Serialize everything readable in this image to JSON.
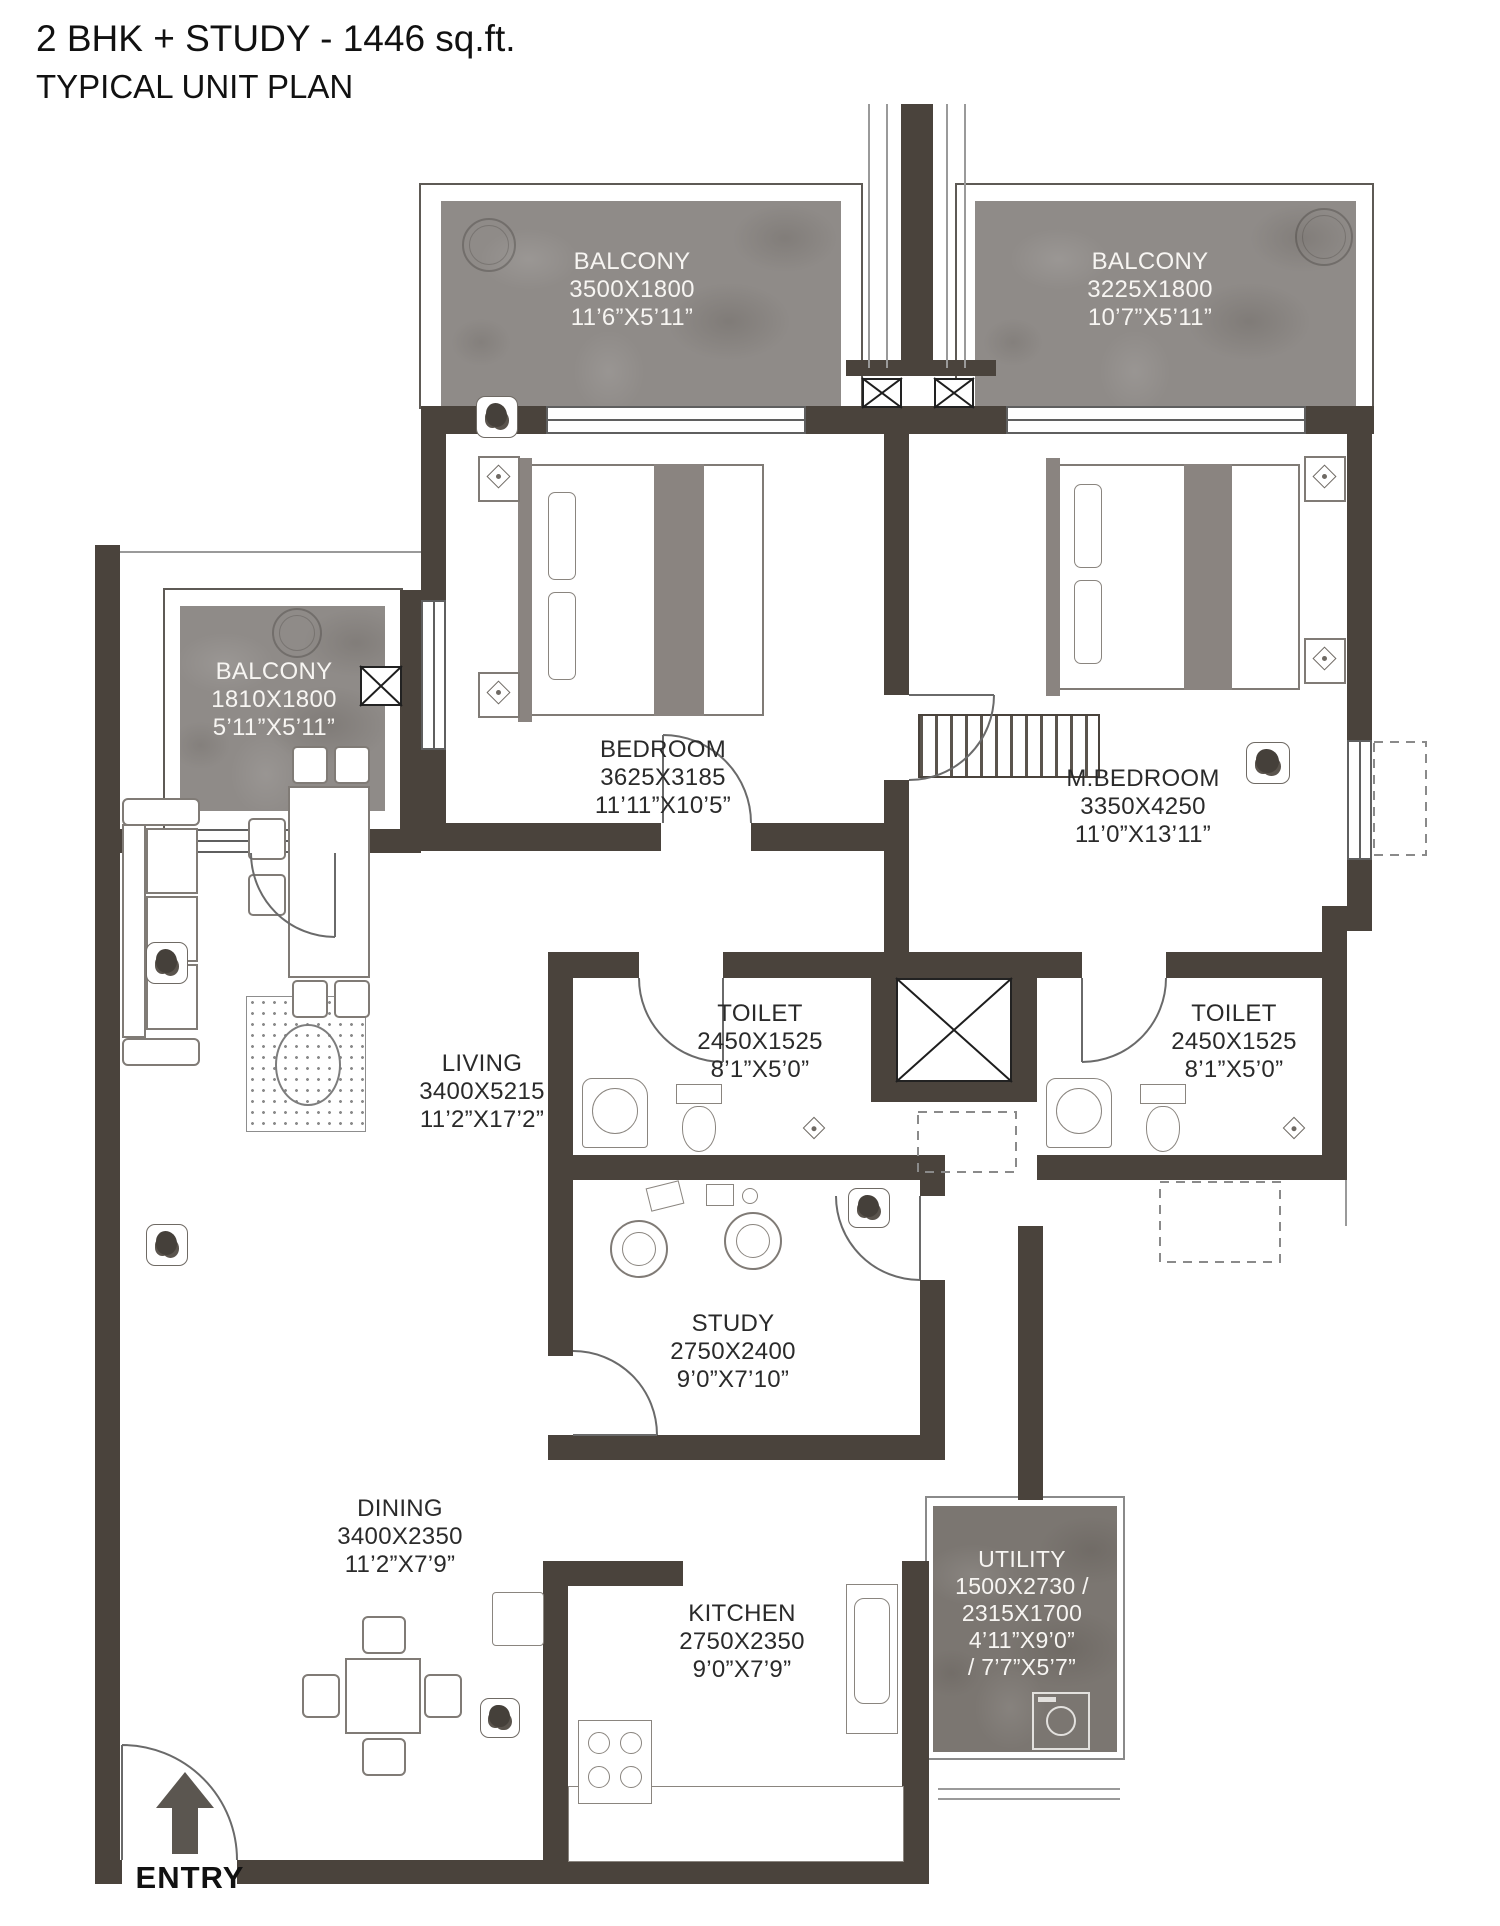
{
  "title": {
    "line1": "2 BHK + STUDY - 1446 sq.ft.",
    "line2": "TYPICAL UNIT PLAN"
  },
  "entry": {
    "label": "ENTRY"
  },
  "colors": {
    "wall": "#4a433c",
    "balcony_fill": "#8f8b88",
    "utility_fill": "#7b7671",
    "balcony_text": "#f7f5f2",
    "label_text": "#2a2a2a",
    "entry_arrow": "#5b5650"
  },
  "rooms": {
    "balcony_top_left": {
      "lines": [
        "BALCONY",
        "3500X1800",
        "11’6”X5’11”"
      ]
    },
    "balcony_top_right": {
      "lines": [
        "BALCONY",
        "3225X1800",
        "10’7”X5’11”"
      ]
    },
    "balcony_left": {
      "lines": [
        "BALCONY",
        "1810X1800",
        "5’11”X5’11”"
      ]
    },
    "bedroom": {
      "lines": [
        "BEDROOM",
        "3625X3185",
        "11’11”X10’5”"
      ]
    },
    "master_bedroom": {
      "lines": [
        "M.BEDROOM",
        "3350X4250",
        "11’0”X13’11”"
      ]
    },
    "living": {
      "lines": [
        "LIVING",
        "3400X5215",
        "11’2”X17’2”"
      ]
    },
    "toilet_left": {
      "lines": [
        "TOILET",
        "2450X1525",
        "8’1”X5’0”"
      ]
    },
    "toilet_right": {
      "lines": [
        "TOILET",
        "2450X1525",
        "8’1”X5’0”"
      ]
    },
    "study": {
      "lines": [
        "STUDY",
        "2750X2400",
        "9’0”X7’10”"
      ]
    },
    "dining": {
      "lines": [
        "DINING",
        "3400X2350",
        "11’2”X7’9”"
      ]
    },
    "kitchen": {
      "lines": [
        "KITCHEN",
        "2750X2350",
        "9’0”X7’9”"
      ]
    },
    "utility": {
      "lines": [
        "UTILITY",
        "1500X2730 /",
        "2315X1700",
        "4’11”X9’0”",
        "/ 7’7”X5’7”"
      ]
    }
  }
}
